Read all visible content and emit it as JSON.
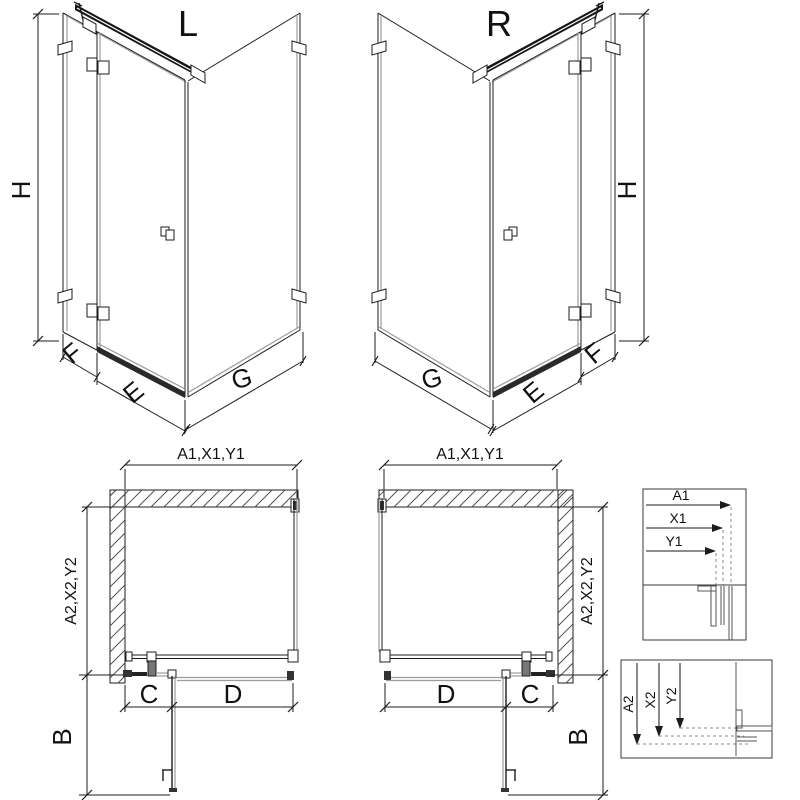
{
  "diagram": {
    "title_left": "L",
    "title_right": "R",
    "iso_left": {
      "height": "H",
      "panel_f": "F",
      "door_e": "E",
      "side_g": "G"
    },
    "iso_right": {
      "height": "H",
      "panel_f": "F",
      "door_e": "E",
      "side_g": "G"
    },
    "plan_left": {
      "top": "A1,X1,Y1",
      "side": "A2,X2,Y2",
      "door_open": "B",
      "fixed_c": "C",
      "door_d": "D"
    },
    "plan_right": {
      "top": "A1,X1,Y1",
      "side": "A2,X2,Y2",
      "door_open": "B",
      "fixed_c": "C",
      "door_d": "D"
    },
    "detail_horizontal": {
      "a1": "A1",
      "x1": "X1",
      "y1": "Y1"
    },
    "detail_vertical": {
      "a2": "A2",
      "x2": "X2",
      "y2": "Y2"
    },
    "colors": {
      "line": "#1c1c1c",
      "glass_gray": "#9b9b9b",
      "background": "#ffffff"
    }
  }
}
